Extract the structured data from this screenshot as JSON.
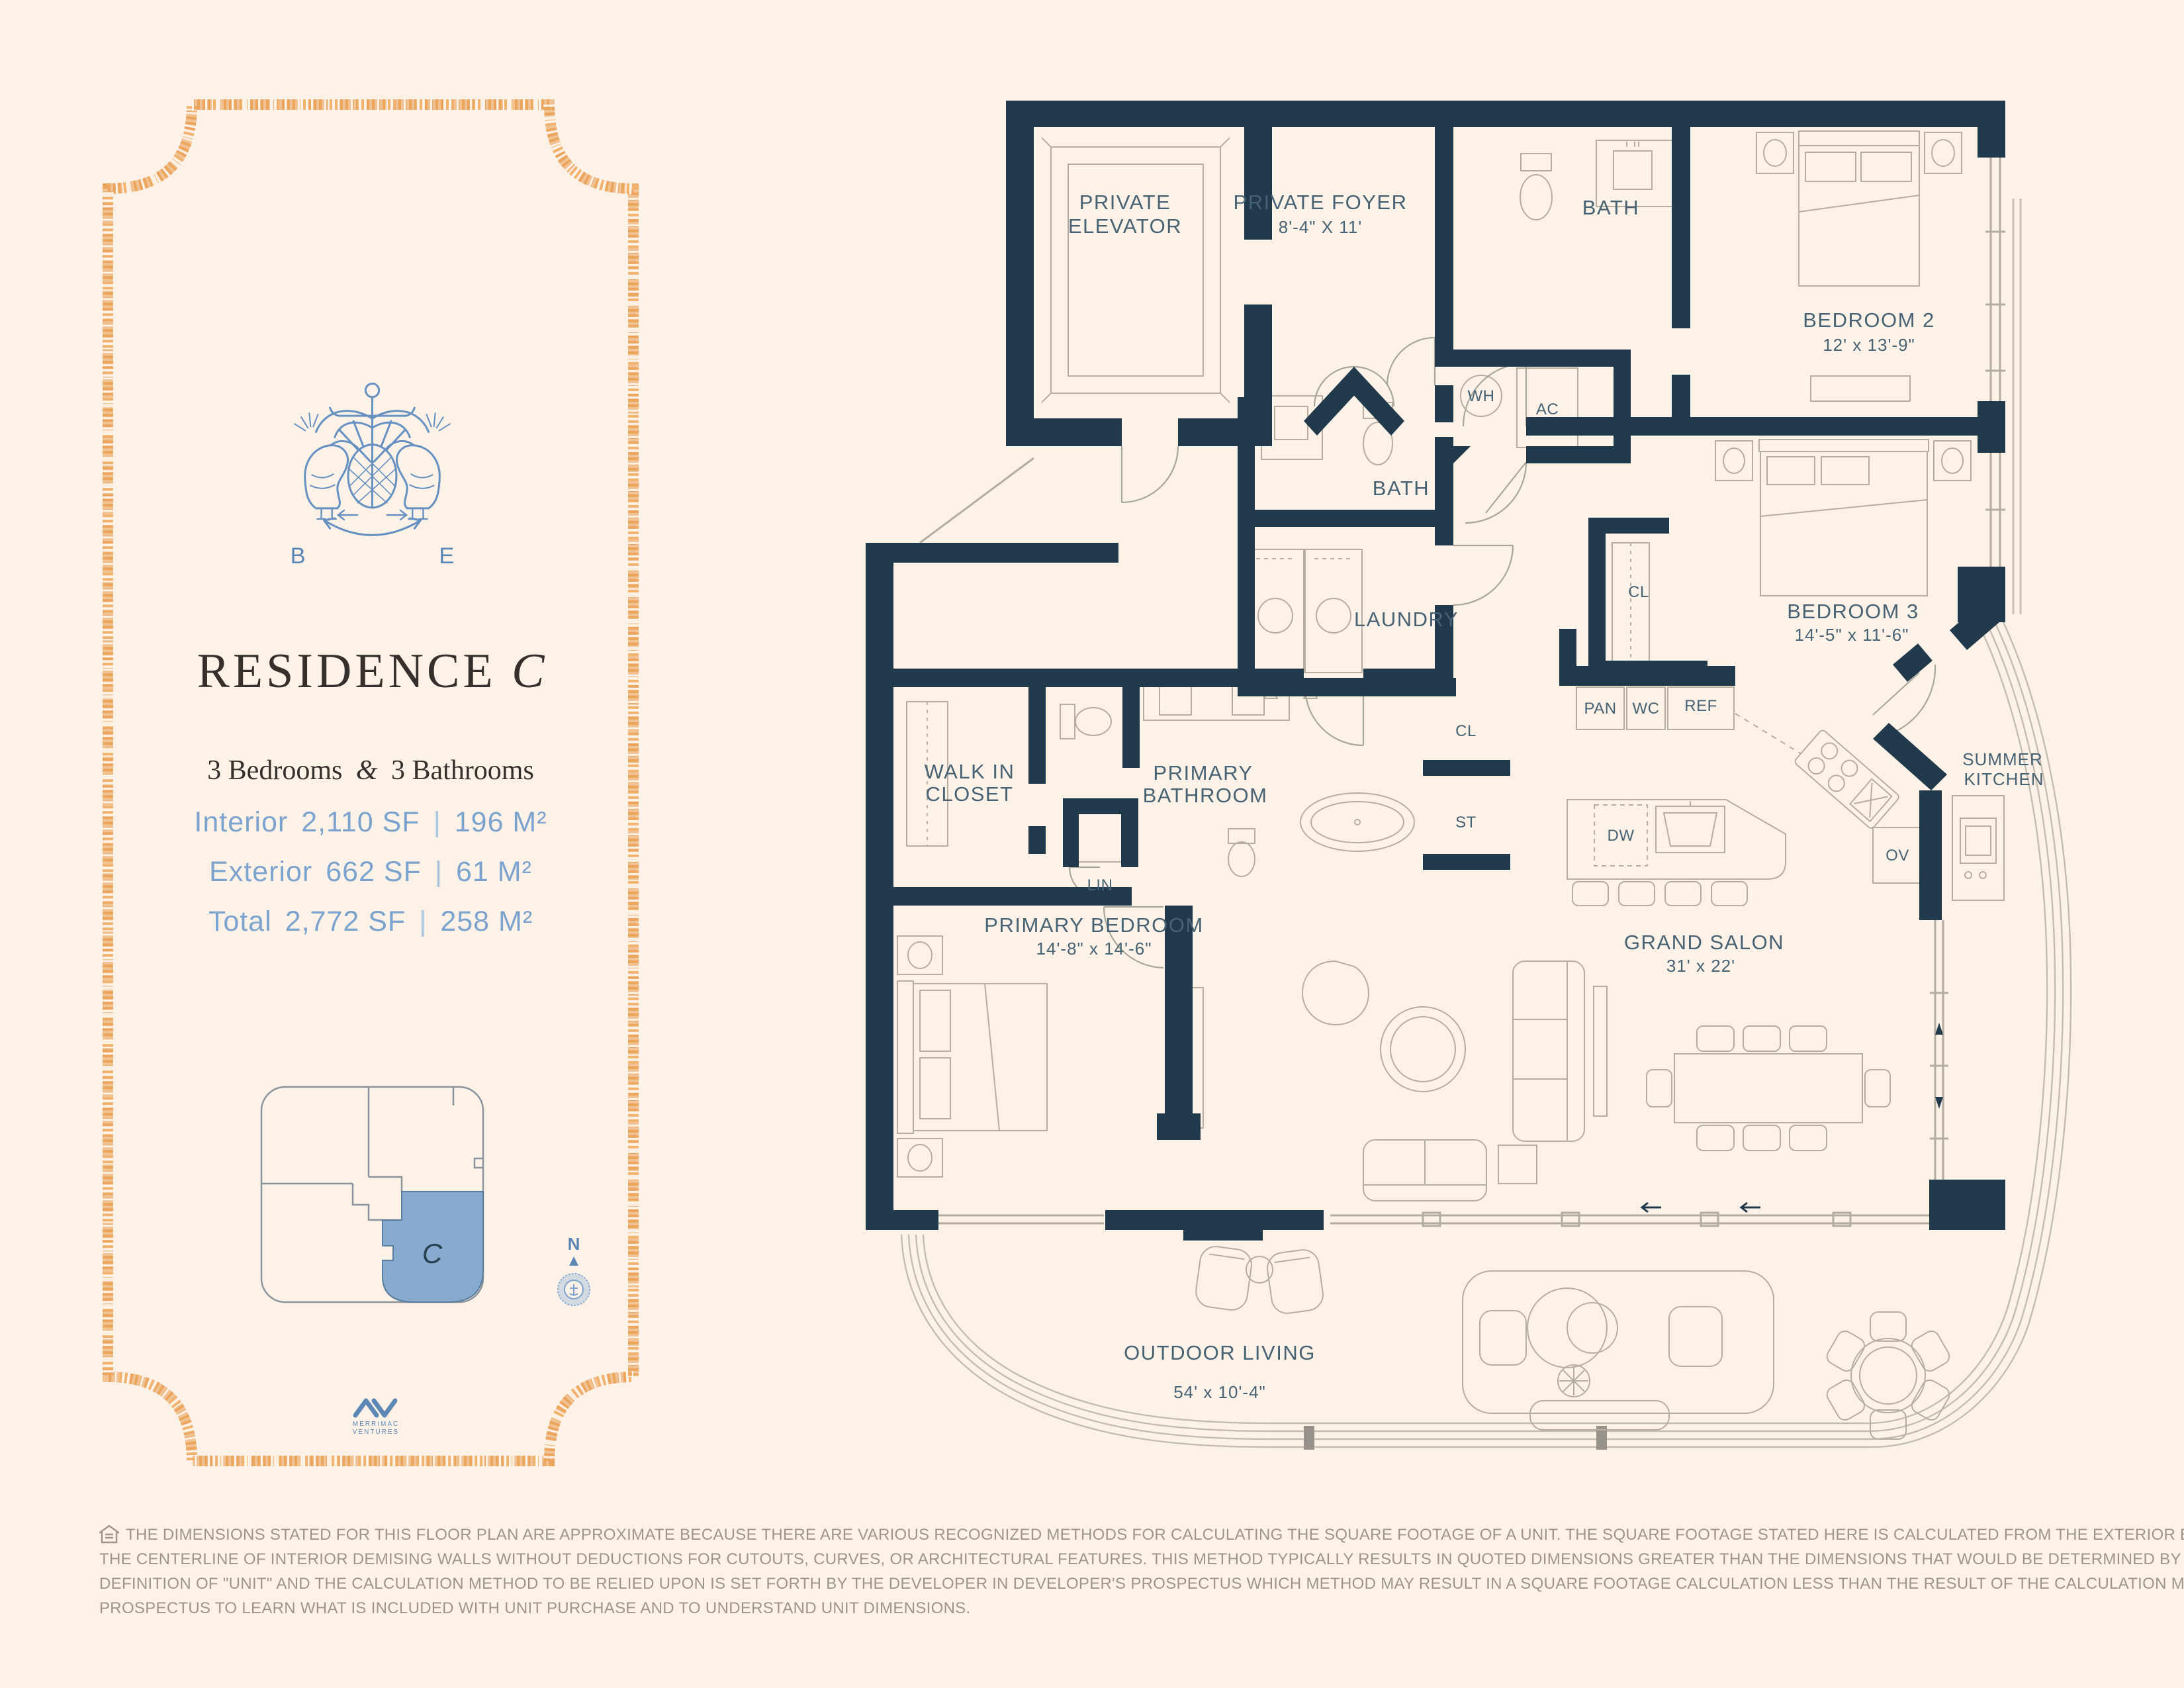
{
  "colors": {
    "background": "#fdf2e8",
    "wall_navy": "#203a4c",
    "label_slate": "#466273",
    "stat_blue": "#7ba3cd",
    "border_orange": "#eda963",
    "keyplan_highlight": "#87abcf",
    "title_charcoal": "#35302b",
    "disclaimer_gray": "#9d958b",
    "crest_blue": "#6691c1"
  },
  "panel": {
    "crest": {
      "left_letter": "B",
      "right_letter": "E"
    },
    "title": "RESIDENCE",
    "title_unit": "C",
    "subtitle": {
      "bedrooms": "3 Bedrooms",
      "ampersand": "&",
      "bathrooms": "3 Bathrooms"
    },
    "stats": [
      {
        "label": "Interior",
        "sf": "2,110 SF",
        "pipe": "|",
        "m2": "196 M²"
      },
      {
        "label": "Exterior",
        "sf": "662 SF",
        "pipe": "|",
        "m2": "61 M²"
      },
      {
        "label": "Total",
        "sf": "2,772 SF",
        "pipe": "|",
        "m2": "258 M²"
      }
    ],
    "keyplan": {
      "unit_label": "C"
    },
    "compass": {
      "north_label": "N"
    },
    "brand": {
      "line1": "MERRIMAC",
      "line2": "VENTURES"
    }
  },
  "plan": {
    "labels": {
      "private_elevator_l1": "PRIVATE",
      "private_elevator_l2": "ELEVATOR",
      "private_foyer": "PRIVATE FOYER",
      "private_foyer_dims": "8'-4\" X 11'",
      "bath_upper": "BATH",
      "wh": "WH",
      "ac": "AC",
      "bedroom2": "BEDROOM 2",
      "bedroom2_dims": "12' x 13'-9\"",
      "bath_middle": "BATH",
      "laundry": "LAUNDRY",
      "cl_hall": "CL",
      "cl_bedroom3": "CL",
      "bedroom3": "BEDROOM 3",
      "bedroom3_dims": "14'-5\" x 11'-6\"",
      "pan": "PAN",
      "wc": "WC",
      "ref": "REF",
      "summer_kitchen_l1": "SUMMER",
      "summer_kitchen_l2": "KITCHEN",
      "walk_in_closet_l1": "WALK IN",
      "walk_in_closet_l2": "CLOSET",
      "primary_bathroom_l1": "PRIMARY",
      "primary_bathroom_l2": "BATHROOM",
      "lin": "LIN",
      "st": "ST",
      "dw": "DW",
      "ov": "OV",
      "primary_bedroom": "PRIMARY BEDROOM",
      "primary_bedroom_dims": "14'-8\" x 14'-6\"",
      "grand_salon": "GRAND SALON",
      "grand_salon_dims": "31' x 22'",
      "outdoor_living": "OUTDOOR LIVING",
      "outdoor_living_dims": "54' x 10'-4\""
    }
  },
  "disclaimer": {
    "lines": [
      "THE DIMENSIONS STATED FOR THIS FLOOR PLAN ARE APPROXIMATE BECAUSE THERE ARE VARIOUS RECOGNIZED METHODS FOR CALCULATING THE SQUARE FOOTAGE OF A UNIT. THE SQUARE FOOTAGE STATED HERE IS CALCULATED FROM THE EXTERIOR BOUNDARIES OF THE EXTERIOR WALLS TO",
      "THE CENTERLINE OF INTERIOR DEMISING WALLS WITHOUT DEDUCTIONS FOR CUTOUTS, CURVES, OR ARCHITECTURAL FEATURES. THIS METHOD TYPICALLY RESULTS IN QUOTED DIMENSIONS GREATER THAN THE DIMENSIONS THAT WOULD BE DETERMINED BY USING OTHER ACCEPTED METHODS. THE",
      "DEFINITION OF \"UNIT\" AND THE CALCULATION METHOD TO BE RELIED UPON IS SET FORTH BY THE DEVELOPER IN DEVELOPER'S PROSPECTUS WHICH METHOD MAY RESULT IN A SQUARE FOOTAGE CALCULATION LESS THAN THE RESULT OF THE CALCULATION METHOD USED HERE. CONSULT THE DEVELOPER'",
      "PROSPECTUS TO LEARN WHAT IS INCLUDED WITH UNIT PURCHASE AND TO UNDERSTAND UNIT DIMENSIONS."
    ]
  }
}
